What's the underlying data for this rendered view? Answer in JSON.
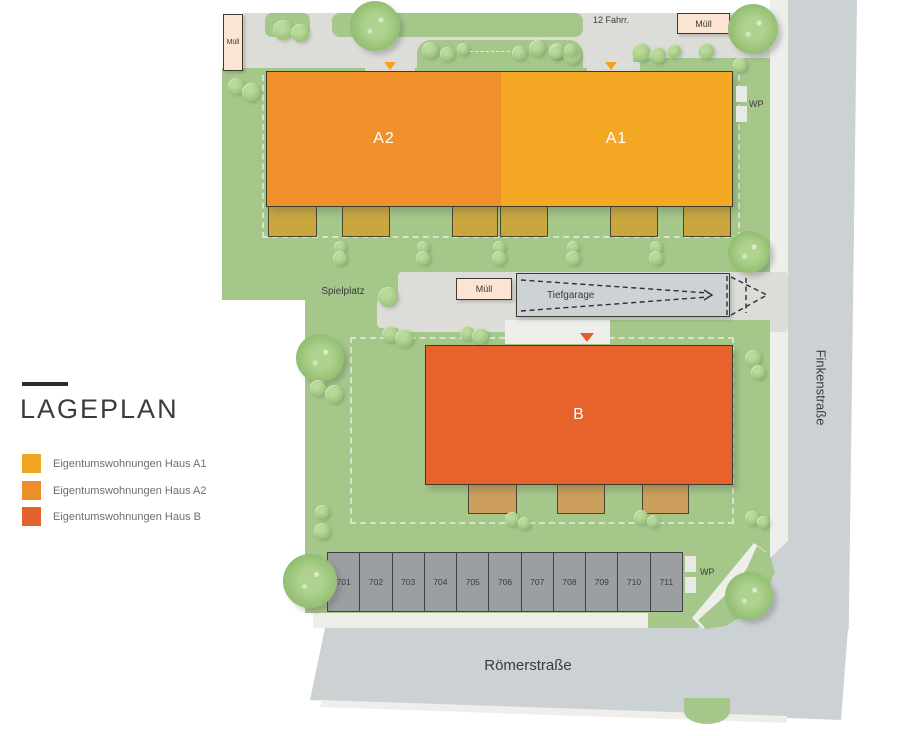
{
  "legend": {
    "title": "LAGEPLAN",
    "items": [
      {
        "label": "Eigentumswohnungen Haus A1",
        "color": "#F2A51F"
      },
      {
        "label": "Eigentumswohnungen Haus A2",
        "color": "#EF8D2C"
      },
      {
        "label": "Eigentumswohnungen Haus B",
        "color": "#E6612B"
      }
    ]
  },
  "plan": {
    "buildings": {
      "a2": "A2",
      "a1": "A1",
      "b": "B"
    },
    "labels": {
      "muell_top_left": "Müll",
      "muell_top_right": "Müll",
      "muell_mid": "Müll",
      "bike": "12 Fahrr.",
      "garage": "Tiefgarage",
      "playground": "Spielplatz",
      "wp_top": "WP",
      "wp_bottom": "WP"
    },
    "streets": {
      "right": "Finkenstraße",
      "bottom": "Römerstraße"
    },
    "parking": {
      "spots": [
        "701",
        "702",
        "703",
        "704",
        "705",
        "706",
        "707",
        "708",
        "709",
        "710",
        "711"
      ]
    }
  },
  "colors": {
    "haus_a1": "#F5A823",
    "haus_a2": "#F0902B",
    "haus_b": "#E8622B",
    "site_green": "#A5C88A",
    "street_gray": "#CCD1D3",
    "path_gray": "#DCDCD8",
    "sidewalk": "#EEEEEA",
    "terrace_a": "#C9A73E",
    "terrace_b": "#CD9F5D",
    "muell_fill": "#FBE4D2",
    "parking_fill": "#9C9FA1",
    "marker_a": "#F3A11F",
    "marker_b": "#E85C2B"
  }
}
